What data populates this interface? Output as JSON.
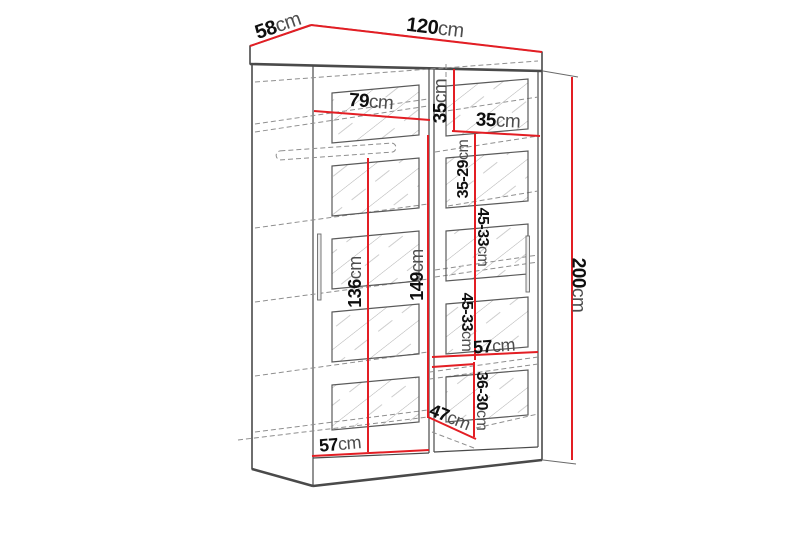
{
  "diagram_type": "wardrobe-dimension-diagram",
  "colors": {
    "dimension_line": "#e31e24",
    "outline": "#4a4a4a",
    "background": "#ffffff"
  },
  "dimensions": {
    "depth": {
      "value": "58",
      "unit": "cm"
    },
    "width": {
      "value": "120",
      "unit": "cm"
    },
    "height": {
      "value": "200",
      "unit": "cm"
    },
    "left_section_width": {
      "value": "79",
      "unit": "cm"
    },
    "top_shelf_height": {
      "value": "35",
      "unit": "cm"
    },
    "top_right_section_width": {
      "value": "35",
      "unit": "cm"
    },
    "upper_right_shelf_spacing": {
      "value": "35-29",
      "unit": "cm"
    },
    "right_shelf_spacing_upper": {
      "value": "45-33",
      "unit": "cm"
    },
    "hanging_space_height": {
      "value": "136",
      "unit": "cm"
    },
    "left_interior_height": {
      "value": "149",
      "unit": "cm"
    },
    "right_shelf_spacing_lower": {
      "value": "45-33",
      "unit": "cm"
    },
    "right_shelf_width": {
      "value": "57",
      "unit": "cm"
    },
    "bottom_right_shelf_spacing": {
      "value": "36-30",
      "unit": "cm"
    },
    "bottom_shelf_depth": {
      "value": "47",
      "unit": "cm"
    },
    "bottom_left_shelf_width": {
      "value": "57",
      "unit": "cm"
    }
  }
}
